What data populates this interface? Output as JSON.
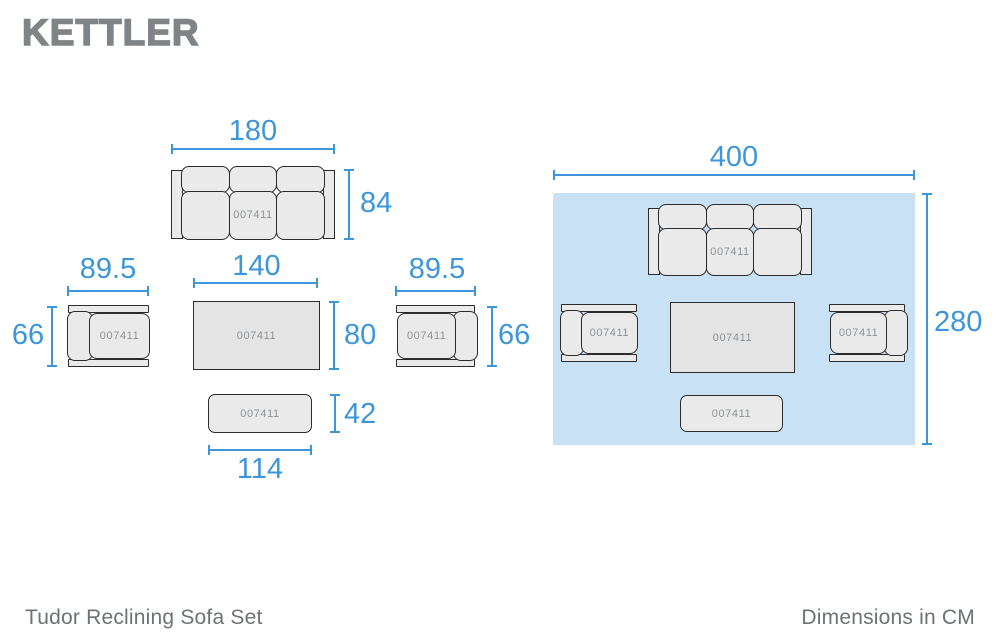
{
  "header": {
    "brand": "KETTLER"
  },
  "product_code": "007411",
  "pieces": {
    "sofa": {
      "width": "180",
      "depth": "84"
    },
    "armchair_left": {
      "width": "89.5",
      "depth": "66"
    },
    "coffee_table": {
      "width": "140",
      "depth": "80"
    },
    "armchair_right": {
      "width": "89.5",
      "depth": "66"
    },
    "bench": {
      "width": "114",
      "depth": "42"
    }
  },
  "footprint": {
    "width": "400",
    "depth": "280"
  },
  "footer": {
    "title": "Tudor Reclining Sofa Set",
    "units": "Dimensions in CM"
  },
  "colors": {
    "accent": "#3e96da",
    "area": "#c9e1f4",
    "fill": "#eaeaea",
    "outline": "#2c2c2c",
    "text_gray": "#6e7276",
    "logo_gray": "#818487",
    "code_gray": "#8e9296"
  }
}
